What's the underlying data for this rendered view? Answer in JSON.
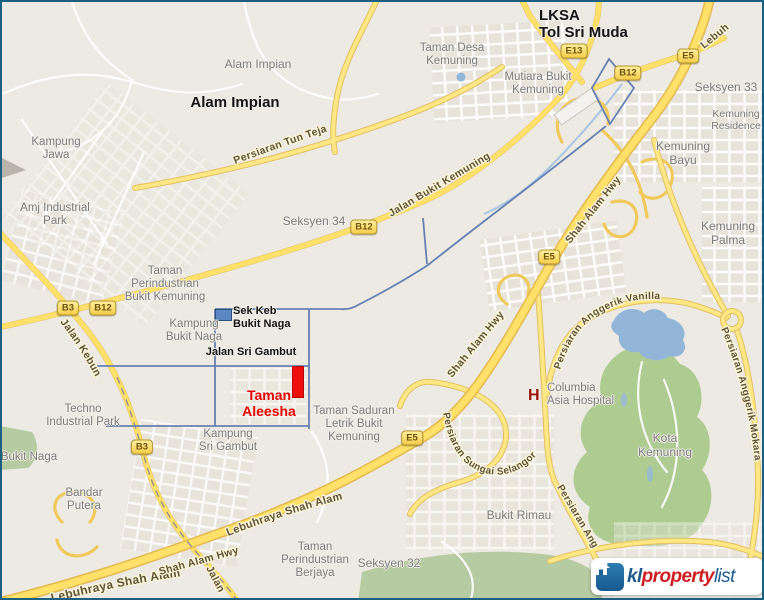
{
  "map": {
    "type": "street-map",
    "area": "Shah Alam / Bukit Kemuning, Malaysia",
    "highlight": "Taman Aleesha"
  },
  "watermark": {
    "brand_prefix": "kl",
    "brand_mid": "property",
    "brand_suffix": "list",
    "icon": "house-icon"
  },
  "colors": {
    "road_major": "#ffe169",
    "boundary_blue": "#6780b0",
    "highlight_red": "#ee0e0e",
    "park_green": "#aecb92",
    "water_blue": "#93b6d8",
    "label_gray": "#7b7b7b"
  },
  "markers": {
    "hospital_letter": "H",
    "school_icon": "school-building-icon",
    "property_icon": "red-rectangle-marker"
  },
  "place_labels": [
    {
      "name": "label-lksa-tol-sri-muda",
      "lines": [
        "LKSA",
        "Tol Sri Muda"
      ],
      "x": 537,
      "y": 5,
      "style": "boldblk",
      "size": 15,
      "align": "left"
    },
    {
      "name": "label-taman-desa-kemuning",
      "lines": [
        "Taman Desa",
        "Kemuning"
      ],
      "x": 450,
      "y": 40,
      "style": "gray"
    },
    {
      "name": "label-mutiara-bukit-kemuning",
      "lines": [
        "Mutiara Bukit",
        "Kemuning"
      ],
      "x": 536,
      "y": 69,
      "style": "gray"
    },
    {
      "name": "label-alam-impian-small",
      "lines": [
        "Alam Impian"
      ],
      "x": 256,
      "y": 56,
      "style": "gray",
      "size": 12
    },
    {
      "name": "label-alam-impian-bold",
      "lines": [
        "Alam Impian"
      ],
      "x": 233,
      "y": 92,
      "style": "boldblk",
      "size": 15
    },
    {
      "name": "label-kampung-jawa",
      "lines": [
        "Kampung",
        "Jawa"
      ],
      "x": 54,
      "y": 134,
      "style": "gray"
    },
    {
      "name": "label-seksyen-33",
      "lines": [
        "Seksyen 33"
      ],
      "x": 724,
      "y": 79,
      "style": "gray",
      "size": 12
    },
    {
      "name": "label-kemuning-residence",
      "lines": [
        "Kemuning",
        "Residence"
      ],
      "x": 734,
      "y": 107,
      "style": "gray",
      "size": 10.5
    },
    {
      "name": "label-kemuning-bayu",
      "lines": [
        "Kemuning",
        "Bayu"
      ],
      "x": 681,
      "y": 138,
      "style": "gray",
      "size": 12
    },
    {
      "name": "label-kemuning-palma",
      "lines": [
        "Kemuning",
        "Palma"
      ],
      "x": 726,
      "y": 218,
      "style": "gray",
      "size": 12
    },
    {
      "name": "label-amj-industrial-park",
      "lines": [
        "Amj Industrial",
        "Park"
      ],
      "x": 53,
      "y": 200,
      "style": "gray"
    },
    {
      "name": "label-seksyen-34",
      "lines": [
        "Seksyen 34"
      ],
      "x": 312,
      "y": 213,
      "style": "gray",
      "size": 12
    },
    {
      "name": "label-taman-perindustrian-bukit-kemuning",
      "lines": [
        "Taman",
        "Perindustrian",
        "Bukit Kemuning"
      ],
      "x": 163,
      "y": 263,
      "style": "gray"
    },
    {
      "name": "label-sek-keb-bukit-naga",
      "lines": [
        "Sek Keb",
        "Bukit Naga"
      ],
      "x": 231,
      "y": 303,
      "style": "boldblk",
      "size": 11,
      "align": "left"
    },
    {
      "name": "label-kampung-bukit-naga",
      "lines": [
        "Kampung",
        "Bukit Naga"
      ],
      "x": 192,
      "y": 316,
      "style": "gray"
    },
    {
      "name": "label-jalan-sri-gambut",
      "lines": [
        "Jalan Sri Gambut"
      ],
      "x": 249,
      "y": 344,
      "style": "boldblk",
      "size": 11
    },
    {
      "name": "label-taman-aleesha",
      "lines": [
        "Taman",
        "Aleesha"
      ],
      "x": 267,
      "y": 386,
      "style": "redbold",
      "size": 14
    },
    {
      "name": "label-taman-saduran",
      "lines": [
        "Taman Saduran",
        "Letrik Bukit",
        "Kemuning"
      ],
      "x": 352,
      "y": 403,
      "style": "gray"
    },
    {
      "name": "label-kampung-sri-gambut",
      "lines": [
        "Kampung",
        "Sri Gambut"
      ],
      "x": 226,
      "y": 426,
      "style": "gray"
    },
    {
      "name": "label-techno-industrial-park",
      "lines": [
        "Techno",
        "Industrial Park"
      ],
      "x": 81,
      "y": 401,
      "style": "gray"
    },
    {
      "name": "label-bukit-naga",
      "lines": [
        "Bukit Naga"
      ],
      "x": 27,
      "y": 449,
      "style": "gray"
    },
    {
      "name": "label-bandar-putera",
      "lines": [
        "Bandar",
        "Putera"
      ],
      "x": 82,
      "y": 485,
      "style": "gray"
    },
    {
      "name": "label-columbia-asia-hospital",
      "lines": [
        "Columbia",
        "Asia Hospital"
      ],
      "x": 545,
      "y": 380,
      "style": "gray",
      "align": "left"
    },
    {
      "name": "label-kota-kemuning",
      "lines": [
        "Kota",
        "Kemuning"
      ],
      "x": 663,
      "y": 430,
      "style": "gray",
      "size": 12
    },
    {
      "name": "label-bukit-rimau",
      "lines": [
        "Bukit Rimau"
      ],
      "x": 517,
      "y": 507,
      "style": "gray",
      "size": 12
    },
    {
      "name": "label-taman-perindustrian-berjaya",
      "lines": [
        "Taman",
        "Perindustrian",
        "Berjaya"
      ],
      "x": 313,
      "y": 539,
      "style": "gray"
    },
    {
      "name": "label-seksyen-32",
      "lines": [
        "Seksyen 32"
      ],
      "x": 387,
      "y": 555,
      "style": "gray",
      "size": 12
    }
  ],
  "badges": [
    {
      "text": "E13",
      "x": 572,
      "y": 49
    },
    {
      "text": "B12",
      "x": 626,
      "y": 71
    },
    {
      "text": "E5",
      "x": 686,
      "y": 54
    },
    {
      "text": "B12",
      "x": 362,
      "y": 225
    },
    {
      "text": "B3",
      "x": 66,
      "y": 306
    },
    {
      "text": "B12",
      "x": 101,
      "y": 306
    },
    {
      "text": "E5",
      "x": 547,
      "y": 255
    },
    {
      "text": "E5",
      "x": 410,
      "y": 436
    },
    {
      "text": "B3",
      "x": 140,
      "y": 445
    }
  ],
  "road_labels": [
    {
      "name": "persiaran-tun-teja",
      "text": "Persiaran Tun Teja"
    },
    {
      "name": "jalan-bukit-kemuning",
      "text": "Jalan Bukit Kemuning"
    },
    {
      "name": "jalan-kebun",
      "text": "Jalan Kebun"
    },
    {
      "name": "jalan-south",
      "text": "Jalan"
    },
    {
      "name": "lebuhraya-shah-alam-bottom",
      "text": "Lebuhraya Shah Alam"
    },
    {
      "name": "lebuhraya-shah-alam-mid",
      "text": "Lebuhraya Shah Alam"
    },
    {
      "name": "shah-alam-hwy-bottom",
      "text": "Shah Alam Hwy"
    },
    {
      "name": "shah-alam-hwy-mid",
      "text": "Shah Alam Hwy"
    },
    {
      "name": "shah-alam-hwy-upper",
      "text": "Shah Alam Hwy"
    },
    {
      "name": "lebuh-corner",
      "text": "Lebuh"
    },
    {
      "name": "persiaran-anggerik-vanilla",
      "text": "Persiaran Anggerik Vanilla"
    },
    {
      "name": "persiaran-sungai-selangor",
      "text": "Persiaran Sungai Selangor"
    },
    {
      "name": "persiaran-anggerik-mokara",
      "text": "Persiaran Anggerik Mokara"
    },
    {
      "name": "persiaran-ang-partial",
      "text": "Persiaran Ang"
    }
  ]
}
